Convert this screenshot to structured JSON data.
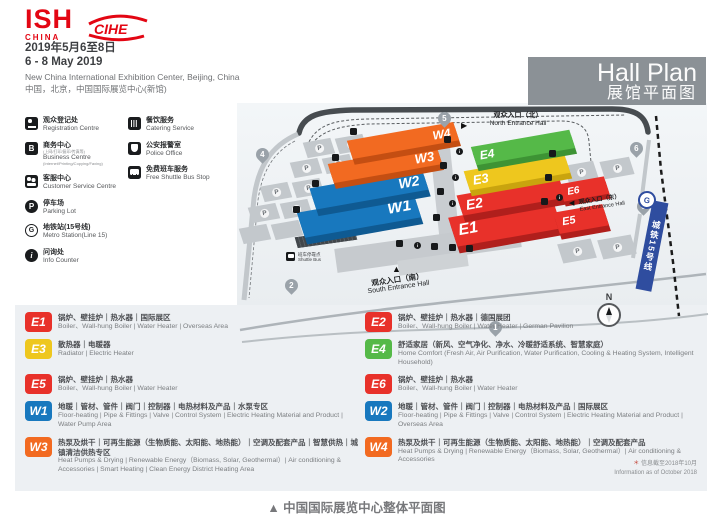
{
  "header": {
    "logo_ish": "ISH",
    "logo_ish_sub": "CHINA",
    "logo_cihe": "CIHE",
    "date_cn": "2019年5月6至8日",
    "date_en": "6 - 8 May 2019",
    "venue_en": "New China International Exhibition Center, Beijing, China",
    "venue_cn": "中国，北京，中国国际展览中心(新馆)",
    "title_en": "Hall Plan",
    "title_cn": "展馆平面图"
  },
  "colors": {
    "red": "#e8312a",
    "yellow": "#eec71e",
    "green": "#55b948",
    "blue": "#1878be",
    "orange": "#f26a21",
    "brand_red": "#e30613",
    "metro_blue": "#2f4d9f"
  },
  "facilities": {
    "col1": [
      {
        "icon": "registration-desk-icon",
        "cn": "观众登记处",
        "en": "Registration Centre"
      },
      {
        "icon": "business-centre-icon",
        "letter": "B",
        "cn": "商务中心",
        "cn_sub": "(上网/打印/复印/传真等)",
        "en": "Business Centre",
        "en_sub": "(Internet/Printing/Copying/Faxing)"
      },
      {
        "icon": "customer-service-icon",
        "cn": "客服中心",
        "en": "Customer Service Centre"
      },
      {
        "icon": "parking-icon",
        "letter": "P",
        "cn": "停车场",
        "en": "Parking Lot"
      },
      {
        "icon": "metro-icon",
        "letter": "G",
        "cn": "地铁站(15号线)",
        "en": "Metro Station(Line 15)"
      },
      {
        "icon": "info-icon",
        "letter": "i",
        "cn": "问询处",
        "en": "Info Counter"
      }
    ],
    "col2": [
      {
        "icon": "catering-icon",
        "cn": "餐饮服务",
        "en": "Catering Service"
      },
      {
        "icon": "police-icon",
        "cn": "公安报警室",
        "en": "Police Office"
      },
      {
        "icon": "shuttle-bus-icon",
        "cn": "免费班车服务",
        "en": "Free Shuttle Bus Stop"
      }
    ]
  },
  "map": {
    "halls": [
      {
        "id": "W1",
        "label": "W1"
      },
      {
        "id": "W2",
        "label": "W2"
      },
      {
        "id": "W3",
        "label": "W3"
      },
      {
        "id": "W4",
        "label": "W4"
      },
      {
        "id": "E1",
        "label": "E1"
      },
      {
        "id": "E2",
        "label": "E2"
      },
      {
        "id": "E3",
        "label": "E3"
      },
      {
        "id": "E4",
        "label": "E4"
      },
      {
        "id": "E5",
        "label": "E5"
      },
      {
        "id": "E6",
        "label": "E6"
      }
    ],
    "parking_label": "P",
    "gates": [
      "4",
      "5",
      "6",
      "6",
      "7",
      "2",
      "1"
    ],
    "entrances": {
      "north_cn": "观众入口（北）",
      "north_en": "North Entrance Hall",
      "east_cn": "观众入口（东）",
      "east_en": "East Entrance Hall",
      "south_cn": "观众入口（南）",
      "south_en": "South Entrance Hall"
    },
    "shuttle_cn": "班车停靠点",
    "shuttle_en": "Shuttle Bus",
    "metro_line_label": "城铁15号线",
    "metro_logo": "G",
    "compass": "N"
  },
  "legend": [
    {
      "id": "E1",
      "cn": "锅炉、壁挂炉｜热水器｜国际展区",
      "en": "Boiler、Wall-hung Boiler | Water Heater | Overseas Area"
    },
    {
      "id": "E2",
      "cn": "锅炉、壁挂炉｜热水器｜德国展团",
      "en": "Boiler、Wall-hung Boiler | Water Heater | German Pavilion"
    },
    {
      "id": "E3",
      "cn": "散热器｜电暖器",
      "en": "Radiator | Electric Heater"
    },
    {
      "id": "E4",
      "cn": "舒适家居（新风、空气净化、净水、冷暖舒适系统、智慧家庭）",
      "en": "Home Comfort (Fresh Air, Air Purification, Water Purification, Cooling & Heating System, Intelligent Household)"
    },
    {
      "id": "E5",
      "cn": "锅炉、壁挂炉｜热水器",
      "en": "Boiler、Wall-hung Boiler | Water Heater"
    },
    {
      "id": "E6",
      "cn": "锅炉、壁挂炉｜热水器",
      "en": "Boiler、Wall-hung Boiler | Water Heater"
    },
    {
      "id": "W1",
      "cn": "地暖｜管材、管件｜阀门｜控制器｜电热材料及产品｜水泵专区",
      "en": "Floor-heating | Pipe & Fittings | Valve | Control System | Electric Heating Material and Product | Water Pump Area"
    },
    {
      "id": "W2",
      "cn": "地暖｜管材、管件｜阀门｜控制器｜电热材料及产品｜国际展区",
      "en": "Floor-heating | Pipe & Fittings | Valve | Control System | Electric Heating Material and Product | Overseas Area"
    },
    {
      "id": "W3",
      "cn": "热泵及烘干｜可再生能源（生物质能、太阳能、地热能）｜空调及配套产品｜智慧供热｜城镇清洁供热专区",
      "en": "Heat Pumps & Drying | Renewable Energy（Biomass, Solar, Geothermal）| Air conditioning & Accessories | Smart Heating | Clean Energy District Heating Area"
    },
    {
      "id": "W4",
      "cn": "热泵及烘干｜可再生能源（生物质能、太阳能、地热能）｜空调及配套产品",
      "en": "Heat Pumps & Drying | Renewable Energy（Biomass, Solar, Geothermal）| Air conditioning & Accessories"
    }
  ],
  "note_star": "＊",
  "note_cn": "信息截至2018年10月",
  "note_en": "Information as of October 2018",
  "caption": "▲  中国国际展览中心整体平面图"
}
